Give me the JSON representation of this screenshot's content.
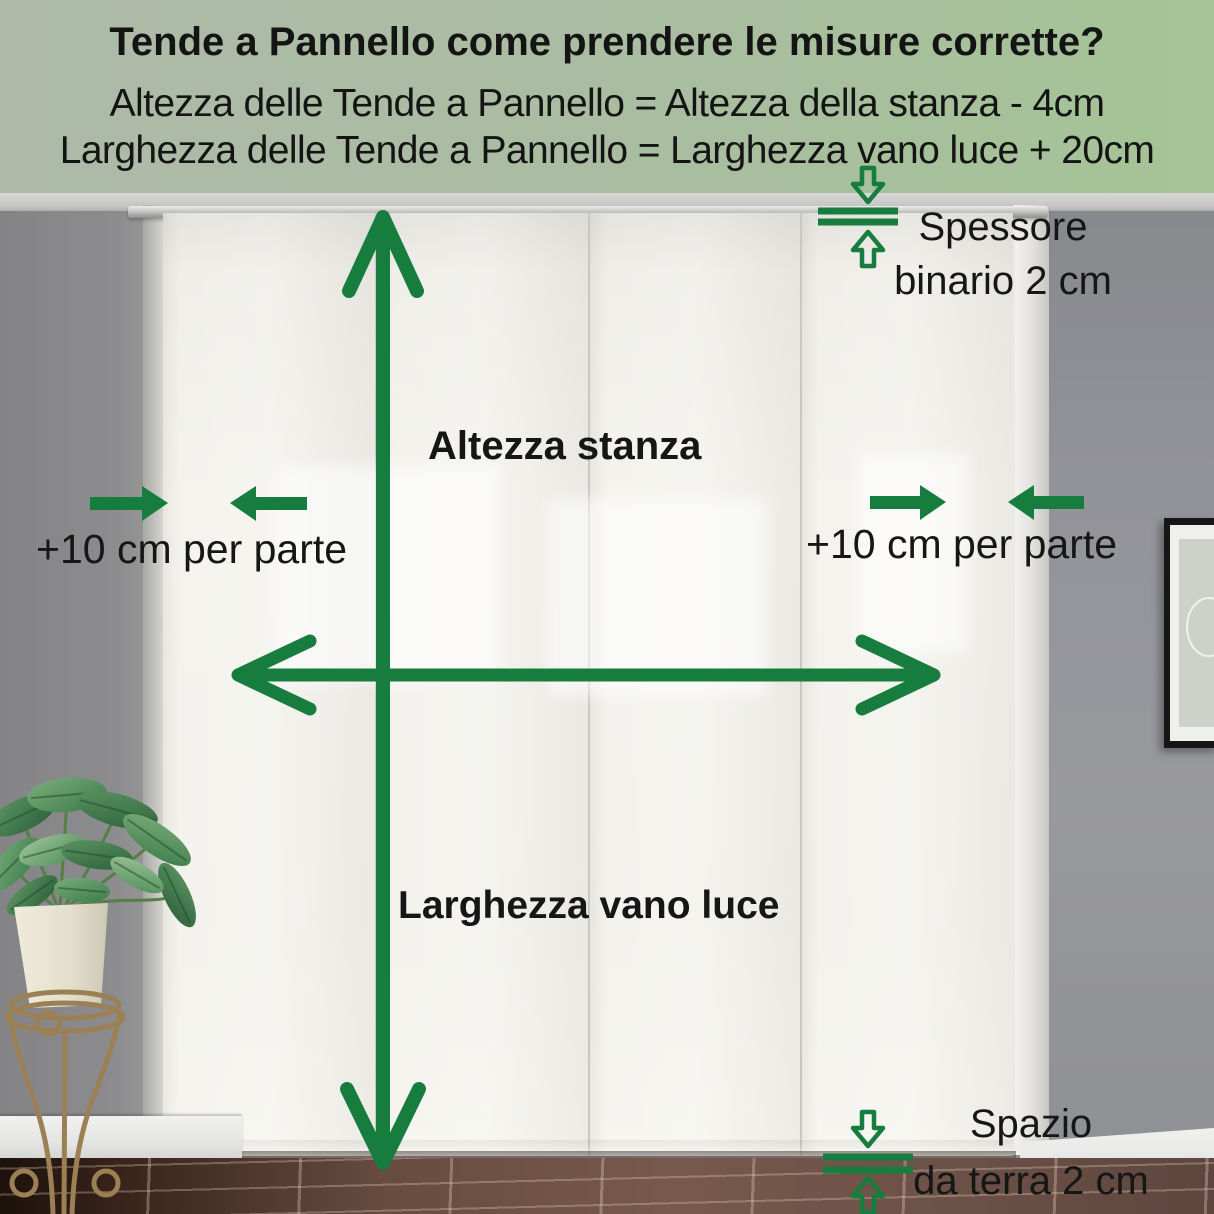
{
  "header": {
    "title": "Tende a Pannello come prendere le misure corrette?",
    "formula_height": "Altezza delle Tende a Pannello = Altezza della stanza - 4cm",
    "formula_width": "Larghezza delle Tende a Pannello = Larghezza vano luce + 20cm"
  },
  "labels": {
    "room_height": "Altezza stanza",
    "window_width": "Larghezza vano luce",
    "side_extension_left": "+10 cm per parte",
    "side_extension_right": "+10 cm per parte",
    "track_thickness_line1": "Spessore",
    "track_thickness_line2": "binario 2 cm",
    "floor_gap_line1": "Spazio",
    "floor_gap_line2": "da terra 2 cm"
  },
  "colors": {
    "annotation_green": "#177d3e",
    "header_bg_left": "#afbaa9",
    "header_bg_right": "#a5c497",
    "text": "#141414"
  },
  "scene": {
    "objects": [
      "panel-curtains",
      "curtain-track",
      "potted-plant",
      "plant-stand",
      "picture-frame",
      "tiled-floor"
    ]
  }
}
